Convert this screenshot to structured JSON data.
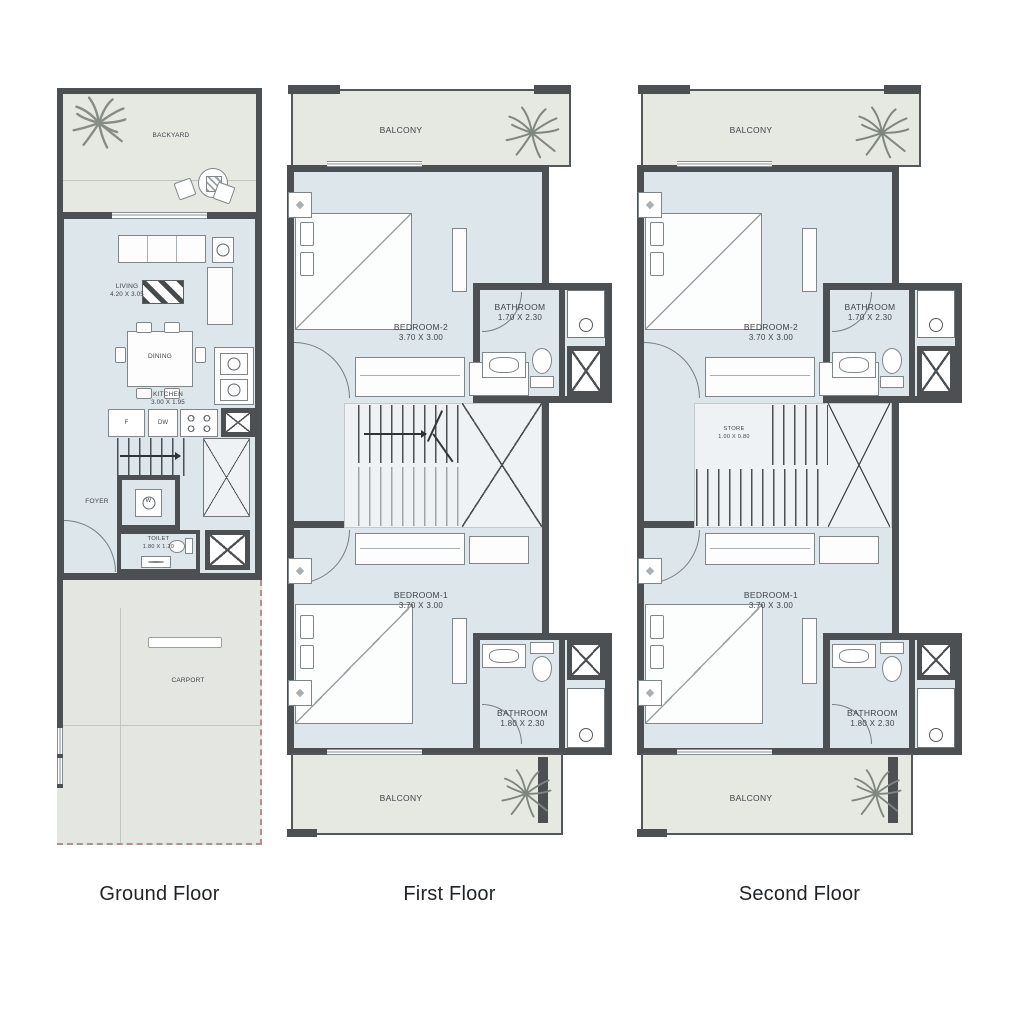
{
  "colors": {
    "wall": "#4c5053",
    "room_fill": "#dde6eb",
    "outdoor_fill": "#e6e8e2",
    "stair_fill": "#eef2f5",
    "carport_dash": "#b58f8f",
    "label_text": "#3f4448",
    "caption_text": "#1f2326"
  },
  "icons": {
    "palm": "palm-tree-starburst",
    "tree": "garden-tree-starburst"
  },
  "floors": {
    "ground": {
      "caption": "Ground Floor",
      "backyard": "BACKYARD",
      "living": "LIVING",
      "living_dim": "4.20 X 3.05",
      "dining": "DINING",
      "kitchen": "KITCHEN",
      "kitchen_dim": "3.00 X 1.95",
      "fridge": "F",
      "dishwasher": "DW",
      "washer": "W",
      "foyer": "FOYER",
      "toilet": "TOILET",
      "toilet_dim": "1.80 X 1.20",
      "carport": "CARPORT"
    },
    "first": {
      "caption": "First Floor",
      "balcony_top": "BALCONY",
      "balcony_bottom": "BALCONY",
      "bedroom2": "BEDROOM-2",
      "bedroom2_dim": "3.70 X 3.00",
      "bathroom2": "BATHROOM",
      "bathroom2_dim": "1.70 X 2.30",
      "bedroom1": "BEDROOM-1",
      "bedroom1_dim": "3.70 X 3.00",
      "bathroom1": "BATHROOM",
      "bathroom1_dim": "1.80 X 2.30"
    },
    "second": {
      "caption": "Second Floor",
      "balcony_top": "BALCONY",
      "balcony_bottom": "BALCONY",
      "bedroom2": "BEDROOM-2",
      "bedroom2_dim": "3.70 X 3.00",
      "bathroom2": "BATHROOM",
      "bathroom2_dim": "1.70 X 2.30",
      "store": "STORE",
      "store_dim": "1.00 X 0.80",
      "bedroom1": "BEDROOM-1",
      "bedroom1_dim": "3.70 X 3.00",
      "bathroom1": "BATHROOM",
      "bathroom1_dim": "1.80 X 2.30"
    }
  }
}
